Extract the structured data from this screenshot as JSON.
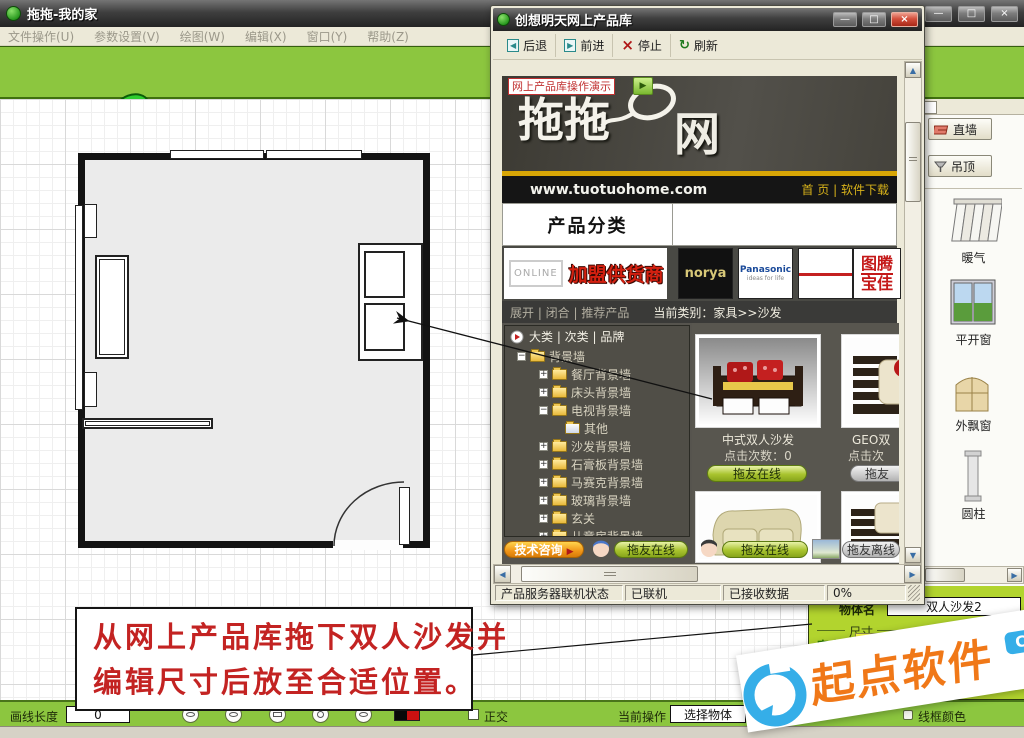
{
  "glyphs": {
    "minimize": "—",
    "restore": "□",
    "close": "×",
    "up_arrow": "▲",
    "down_arrow": "▼",
    "left_arrow": "◀",
    "right_arrow": "▶",
    "play": "▶",
    "stop_x": "×",
    "refresh": "↻",
    "back_i": "◀",
    "fwd_i": "▶"
  },
  "colors": {
    "toolbar_green": "#8cc63f",
    "panel_green": "#b2d42e",
    "annotation_red": "#c32322",
    "watermark_orange": "#f07818",
    "watermark_blue": "#35aee8"
  },
  "main_window": {
    "title": "拖拖-我的家",
    "menu": [
      {
        "label": "文件操作(U)"
      },
      {
        "label": "参数设置(V)"
      },
      {
        "label": "绘图(W)"
      },
      {
        "label": "编辑(X)"
      },
      {
        "label": "窗口(Y)"
      },
      {
        "label": "帮助(Z)"
      }
    ],
    "logo": {
      "brand": "拖拖",
      "site": "tuotuohome.com"
    },
    "toolbar_icons": [
      "new-document",
      "open-library",
      "save",
      "hand-select",
      "view-lens",
      "refresh",
      "delete"
    ],
    "online_products_header": "网上产品"
  },
  "product_window": {
    "title": "创想明天网上产品库",
    "nav": {
      "back": "后退",
      "forward": "前进",
      "stop": "停止",
      "refresh": "刷新"
    },
    "banner": {
      "demo": "网上产品库操作演示",
      "brand": "拖拖",
      "net": "网",
      "site": "www.tuotuohome.com",
      "links": "首 页 | 软件下载"
    },
    "category": {
      "title": "产品分类"
    },
    "supplier": {
      "online": "ONLINE",
      "join": "加盟供货商",
      "brand_norya": "norya",
      "brand_pan": "Panasonic",
      "brand_pan_sub": "ideas for life",
      "seal_line1": "图腾",
      "seal_line2": "宝佳"
    },
    "filter": {
      "left": "展开 | 闭合 | 推荐产品",
      "right": "当前类别：家具>>沙发"
    },
    "tree": {
      "header": "大类 | 次类 | 品牌",
      "items": [
        {
          "label": "背景墙",
          "expander": "−"
        },
        {
          "label": "餐厅背景墙",
          "expander": "+"
        },
        {
          "label": "床头背景墙",
          "expander": "+"
        },
        {
          "label": "电视背景墙",
          "expander": "−"
        },
        {
          "label": "其他",
          "expander": ""
        },
        {
          "label": "沙发背景墙",
          "expander": "+"
        },
        {
          "label": "石膏板背景墙",
          "expander": "+"
        },
        {
          "label": "马赛克背景墙",
          "expander": "+"
        },
        {
          "label": "玻璃背景墙",
          "expander": "+"
        },
        {
          "label": "玄关",
          "expander": "+"
        },
        {
          "label": "儿童房背景墙",
          "expander": "+"
        }
      ]
    },
    "products": [
      {
        "name": "中式双人沙发",
        "clicks": "点击次数：0",
        "button": "拖友在线"
      },
      {
        "name": "GEO双",
        "clicks": "点击次",
        "button": "拖友"
      }
    ],
    "footer": {
      "support": "技术咨询",
      "online1": "拖友在线",
      "online2": "拖友在线",
      "offline": "拖友离线"
    },
    "status": {
      "s1": "产品服务器联机状态",
      "s2": "已联机",
      "s3": "已接收数据",
      "s4": "0%"
    }
  },
  "sidebar": {
    "wall_button": "直墙",
    "ceiling_button": "吊顶",
    "items": [
      {
        "label": "暖气"
      },
      {
        "label": "平开窗"
      },
      {
        "label": "外飘窗"
      },
      {
        "label": "圆柱"
      }
    ]
  },
  "properties_panel": {
    "name_label": "物体名",
    "name_value": "双人沙发2",
    "size_legend": "尺寸",
    "width_label": "宽度",
    "width_value": "1800"
  },
  "bottom_bar": {
    "draw_length_label": "画线长度",
    "draw_length_value": "0",
    "ortho_label": "正交",
    "current_op_label": "当前操作",
    "current_op_value": "选择物体",
    "wireframe_label": "线框颜色"
  },
  "annotation": {
    "line1": "从网上产品库拖下双人沙发并",
    "line2": "编辑尺寸后放至合适位置。"
  },
  "watermark": {
    "brand": "起点软件",
    "badge": "CNCRK",
    "tld": ".COM"
  }
}
